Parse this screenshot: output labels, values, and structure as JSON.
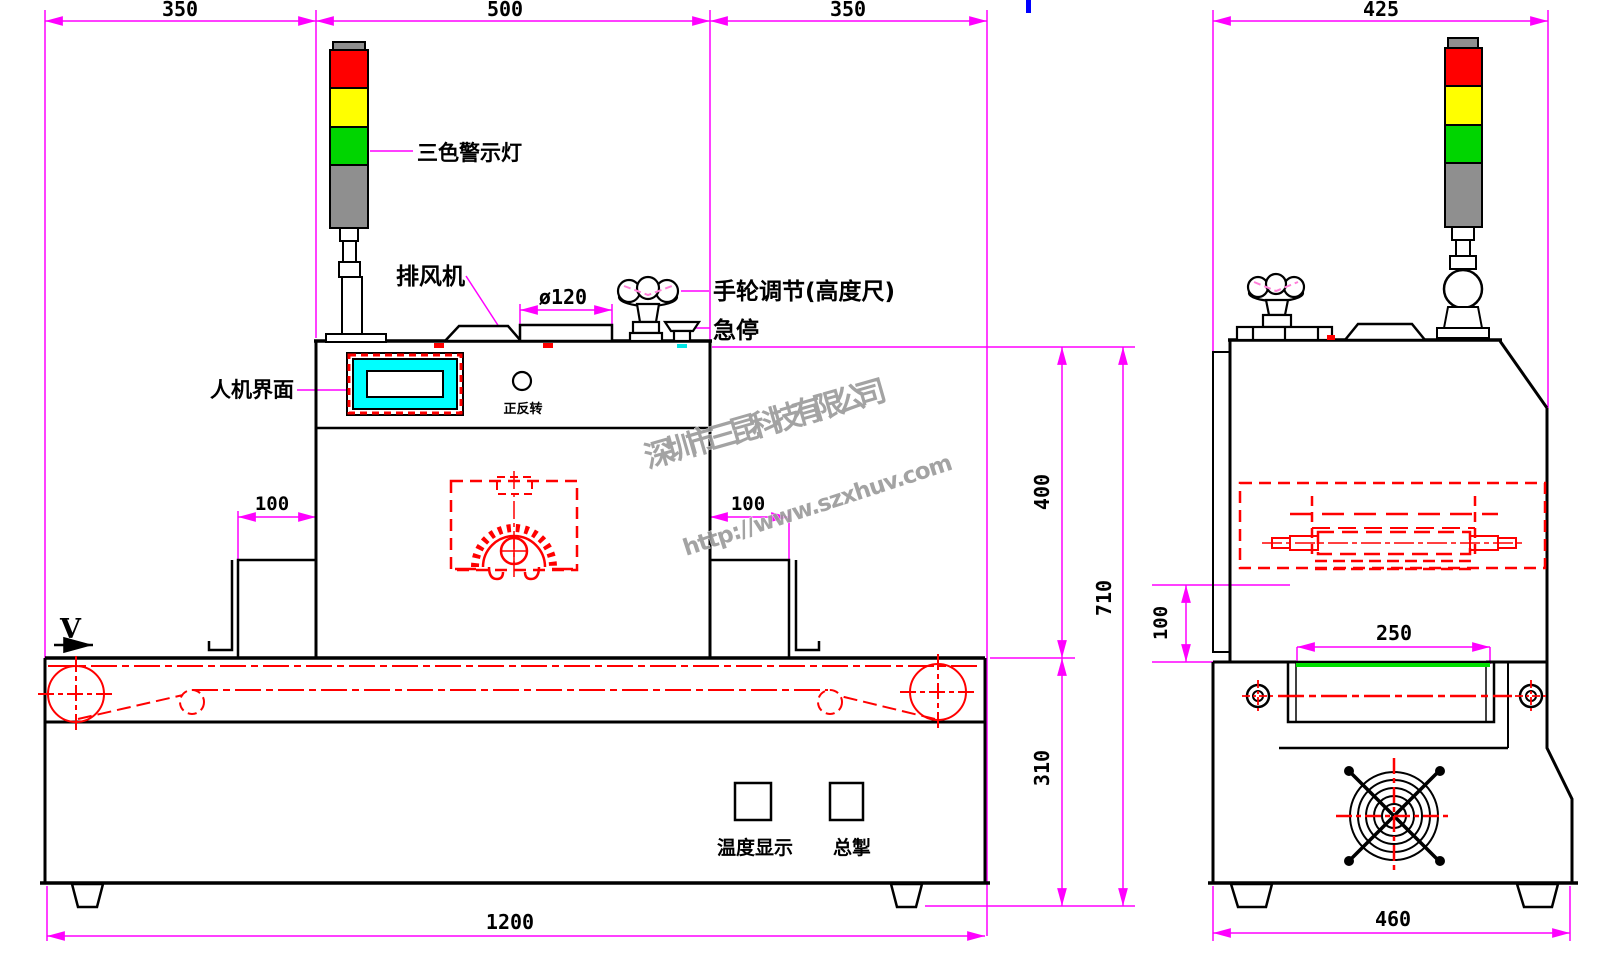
{
  "page": {
    "background": "#ffffff"
  },
  "drawing": {
    "title": "UV curing conveyor machine two-view technical drawing",
    "colors": {
      "outline": "#000000",
      "dimension": "#ff00ff",
      "detail_red": "#ff0000",
      "screen_cyan": "#00ffff",
      "belt_green": "#00e000",
      "light_red": "#ff0000",
      "light_yellow": "#ffff00",
      "light_green": "#00d500",
      "light_gray": "#8f8f8f",
      "watermark_gray": "#9a9a9a",
      "mark_blue": "#0000ff"
    },
    "watermark": {
      "company": "深圳市三昆科技有限公司",
      "url": "http://www.szxhuv.com"
    },
    "front_view": {
      "labels": {
        "tower_light": "三色警示灯",
        "exhaust_fan": "排风机",
        "handwheel": "手轮调节(高度尺)",
        "emergency_stop": "急停",
        "hmi": "人机界面",
        "forward_reverse": "正反转",
        "temperature_display": "温度显示",
        "main_switch": "总掣",
        "belt_direction": "V"
      },
      "dimensions": {
        "top_left": "350",
        "top_center": "500",
        "top_right": "350",
        "duct": "ø120",
        "left_opening": "100",
        "right_opening": "100",
        "upper_height": "400",
        "total_height": "710",
        "lower_height": "310",
        "overall_length": "1200"
      }
    },
    "side_view": {
      "dimensions": {
        "top_width": "425",
        "chamber_opening": "100",
        "belt_width": "250",
        "base_width": "460"
      }
    }
  }
}
